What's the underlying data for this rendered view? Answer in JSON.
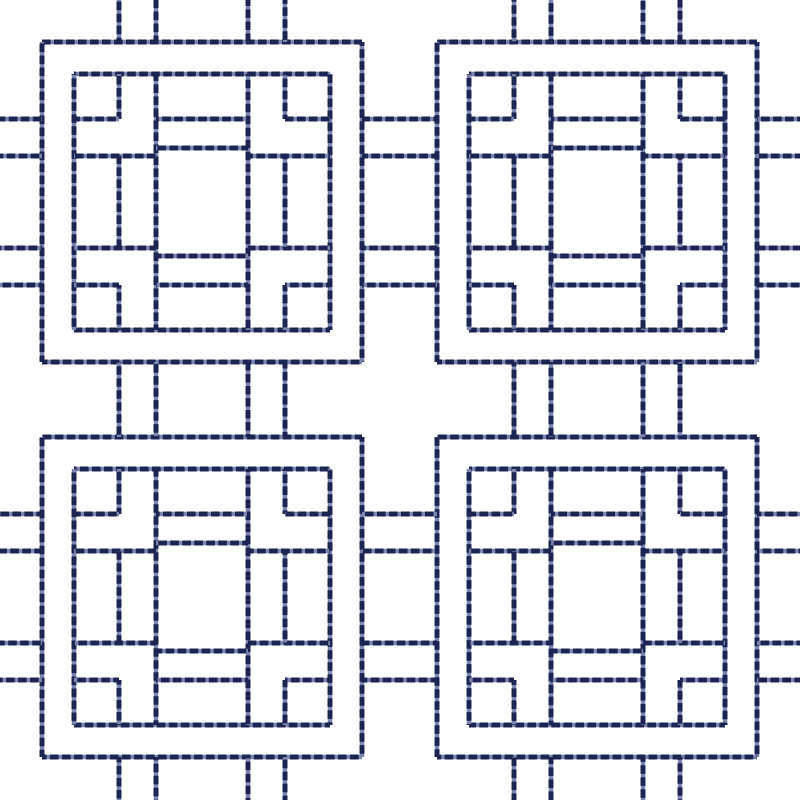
{
  "canvas": {
    "width": 800,
    "height": 800,
    "background_color": "#ffffff"
  },
  "stitch_style": {
    "dark_thread_color": "#1b2453",
    "light_thread_color": "#7b85ad",
    "stroke_width": 5,
    "dash_length": 8.6,
    "dash_gap": 3.4
  },
  "pattern": {
    "motif_size": 320,
    "motif_origins": [
      [
        42,
        42
      ],
      [
        437,
        42
      ],
      [
        42,
        437
      ],
      [
        437,
        437
      ]
    ],
    "grid_offsets": {
      "A": 32,
      "B": 77,
      "C": 114,
      "D": 206,
      "E": 243,
      "F": 288
    },
    "motif_segments": [
      [
        0,
        0,
        320,
        0
      ],
      [
        320,
        0,
        320,
        320
      ],
      [
        320,
        320,
        0,
        320
      ],
      [
        0,
        320,
        0,
        0
      ],
      [
        32,
        32,
        288,
        32
      ],
      [
        288,
        32,
        288,
        288
      ],
      [
        288,
        288,
        32,
        288
      ],
      [
        32,
        288,
        32,
        32
      ],
      [
        114,
        32,
        114,
        288
      ],
      [
        206,
        32,
        206,
        288
      ],
      [
        32,
        114,
        114,
        114
      ],
      [
        206,
        114,
        288,
        114
      ],
      [
        32,
        206,
        114,
        206
      ],
      [
        206,
        206,
        288,
        206
      ],
      [
        114,
        77,
        206,
        77
      ],
      [
        114,
        106,
        206,
        106
      ],
      [
        114,
        214,
        206,
        214
      ],
      [
        114,
        243,
        206,
        243
      ],
      [
        77,
        114,
        77,
        206
      ],
      [
        243,
        114,
        243,
        206
      ],
      [
        77,
        32,
        77,
        77
      ],
      [
        32,
        77,
        77,
        77
      ],
      [
        243,
        32,
        243,
        77
      ],
      [
        243,
        77,
        288,
        77
      ],
      [
        77,
        243,
        77,
        288
      ],
      [
        32,
        243,
        77,
        243
      ],
      [
        243,
        243,
        243,
        288
      ],
      [
        243,
        243,
        288,
        243
      ]
    ],
    "connector_offsets": [
      77,
      114,
      206,
      243
    ],
    "column_origins": [
      42,
      437
    ],
    "row_origins": [
      42,
      437
    ],
    "near_edge_span": [
      0,
      42
    ],
    "far_edge_span": [
      757,
      800
    ],
    "mid_gap_span": [
      362,
      437
    ]
  }
}
